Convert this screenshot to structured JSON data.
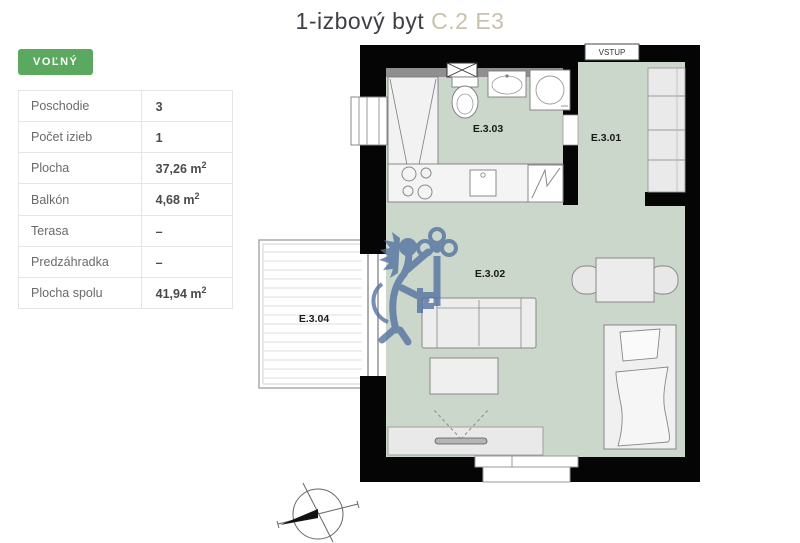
{
  "title": {
    "main": "1-izbový byt",
    "unit": "C.2 E3"
  },
  "status": {
    "label": "VOĽNÝ"
  },
  "details": {
    "rows": [
      {
        "label": "Poschodie",
        "value": "3",
        "sup": ""
      },
      {
        "label": "Počet izieb",
        "value": "1",
        "sup": ""
      },
      {
        "label": "Plocha",
        "value": "37,26 m",
        "sup": "2"
      },
      {
        "label": "Balkón",
        "value": "4,68 m",
        "sup": "2"
      },
      {
        "label": "Terasa",
        "value": "–",
        "sup": ""
      },
      {
        "label": "Predzáhradka",
        "value": "–",
        "sup": ""
      },
      {
        "label": "Plocha spolu",
        "value": "41,94 m",
        "sup": "2"
      }
    ]
  },
  "floorplan": {
    "entry_label": "VSTUP",
    "rooms": [
      {
        "id": "E.3.01"
      },
      {
        "id": "E.3.02"
      },
      {
        "id": "E.3.03"
      },
      {
        "id": "E.3.04"
      }
    ]
  },
  "colors": {
    "accent_green": "#5aa95f",
    "room_fill": "#cbd7ca",
    "wall": "#050505",
    "watermark_blue": "#51709f",
    "unit_beige": "#c9c1ac"
  }
}
